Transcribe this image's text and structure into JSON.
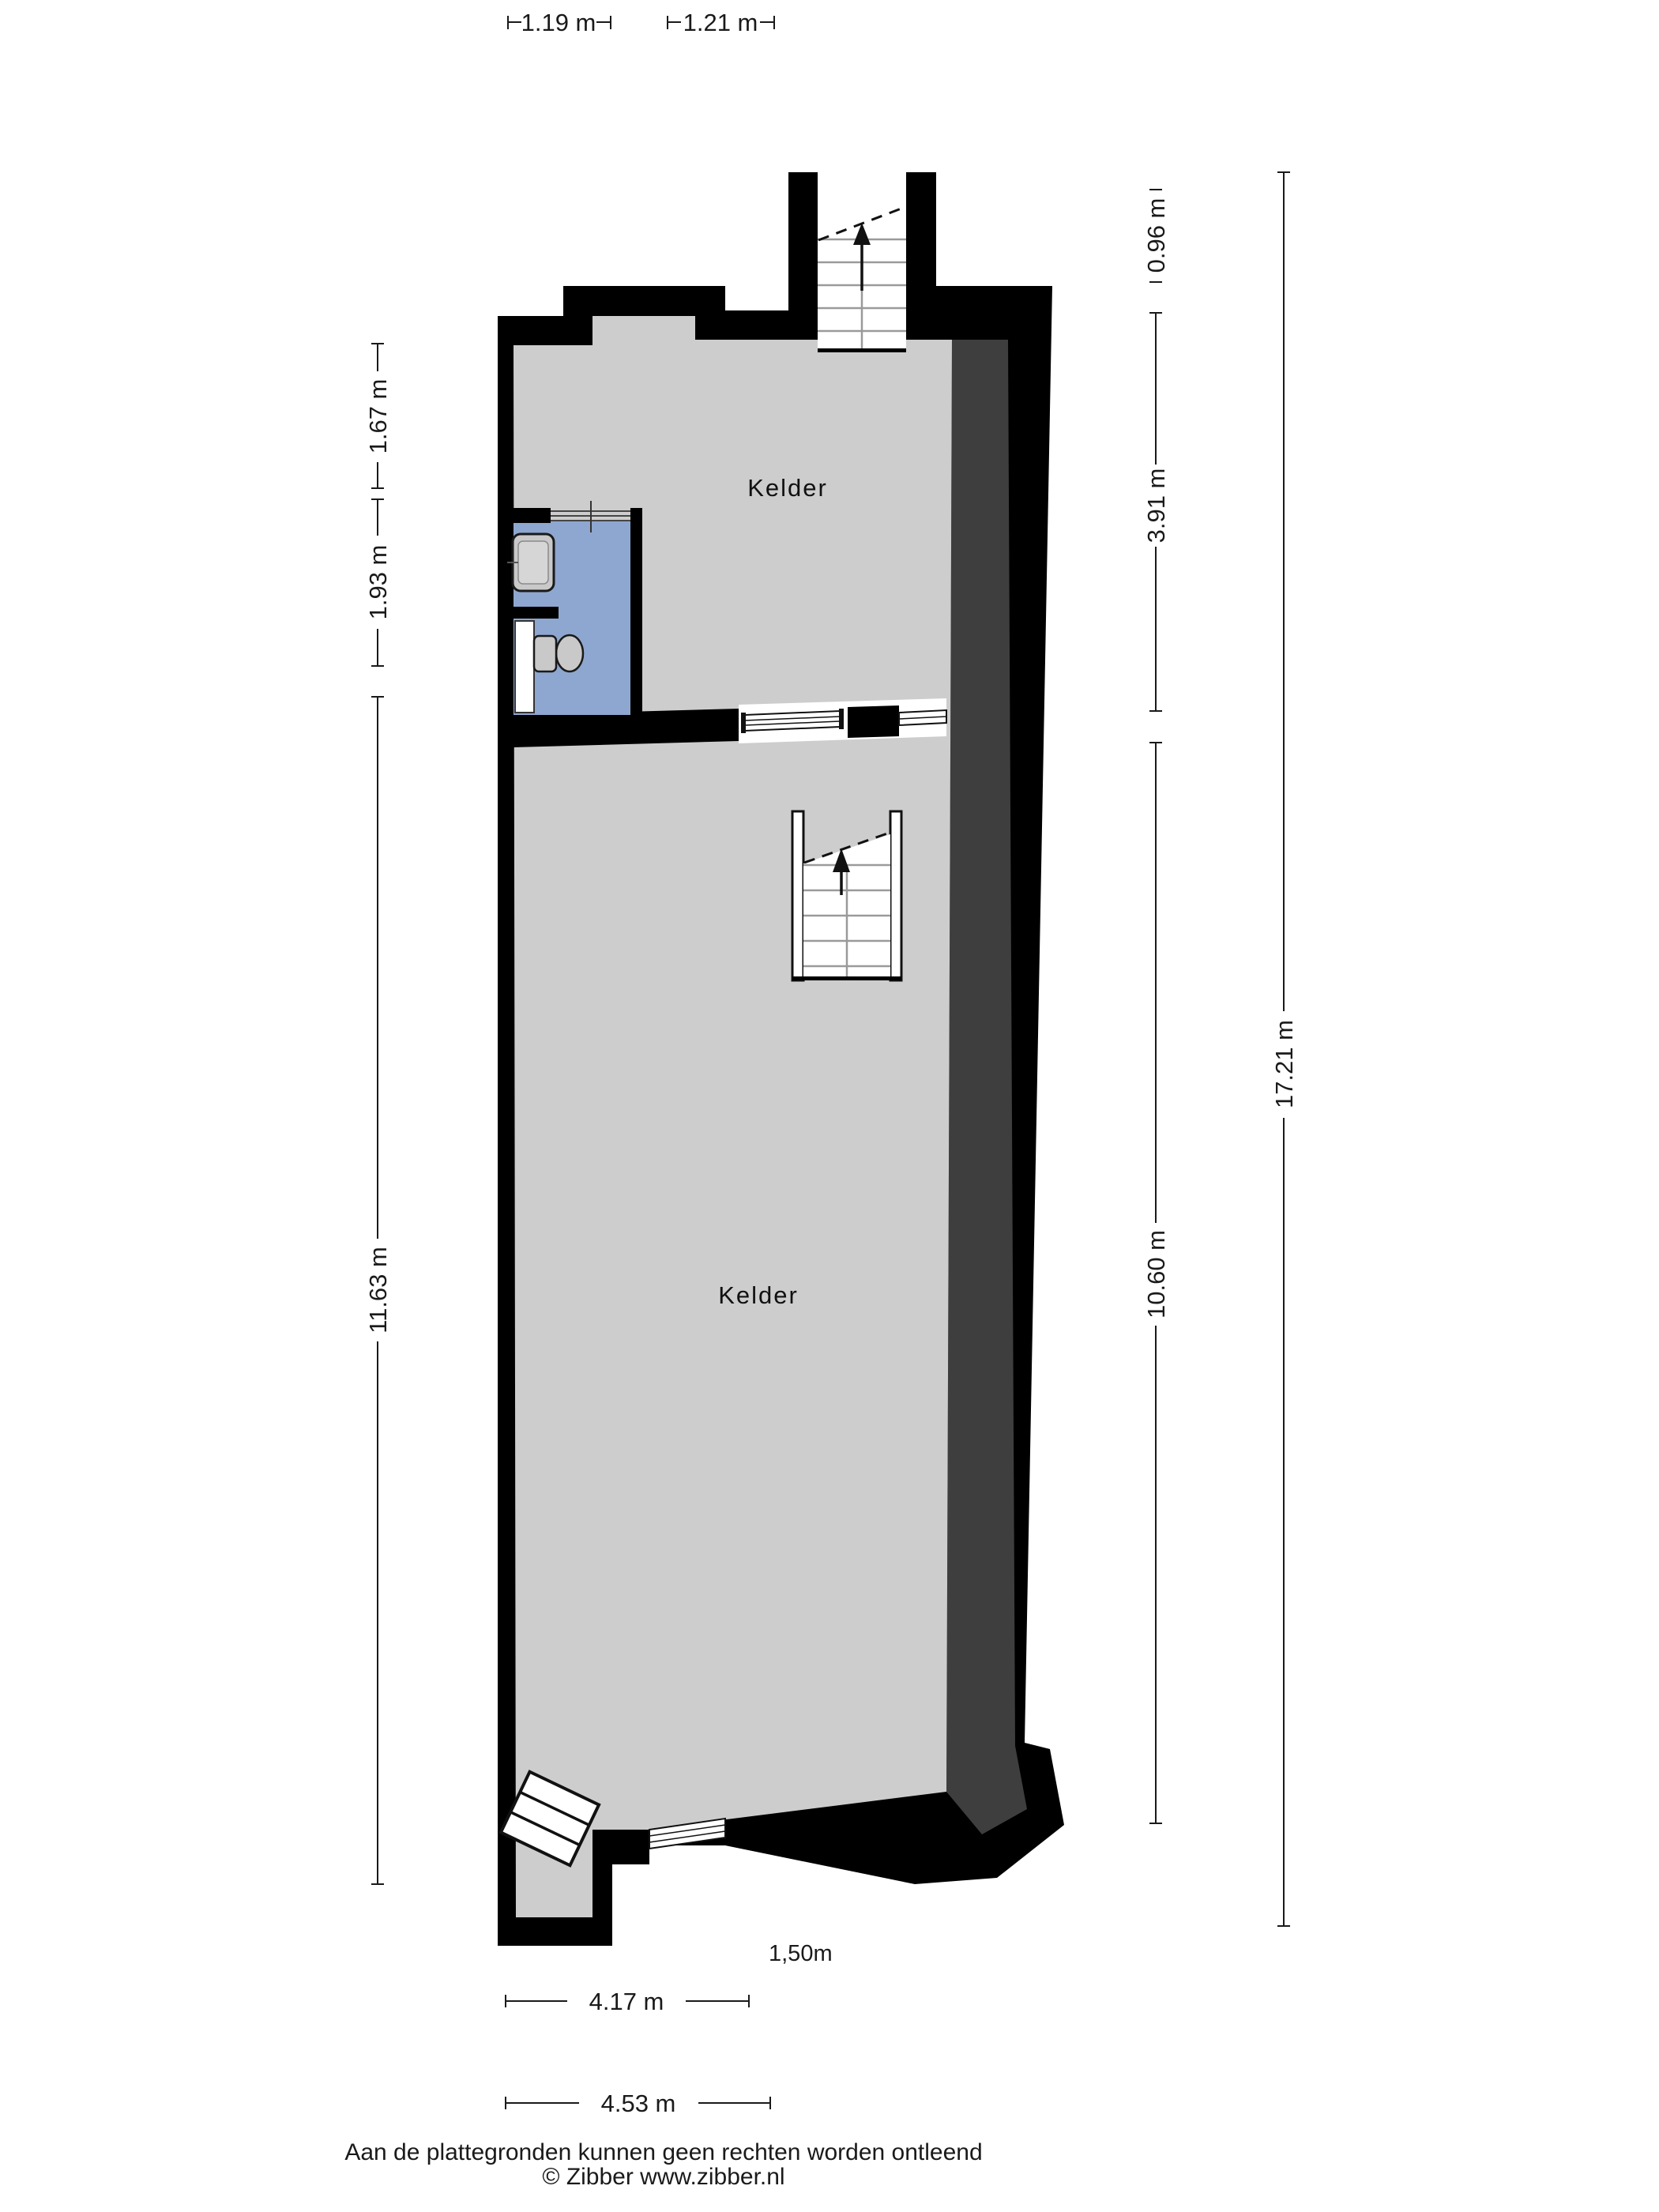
{
  "plan": {
    "rooms": [
      {
        "label": "Kelder"
      },
      {
        "label": "Kelder"
      }
    ],
    "height_marker": "1,50m"
  },
  "dimensions": {
    "top": [
      {
        "label": "1.19 m"
      },
      {
        "label": "1.21 m"
      }
    ],
    "left": [
      {
        "label": "1.67 m"
      },
      {
        "label": "1.93 m"
      },
      {
        "label": "11.63 m"
      }
    ],
    "right": [
      {
        "label": "0.96 m"
      },
      {
        "label": "3.91 m"
      },
      {
        "label": "10.60 m"
      },
      {
        "label": "17.21 m"
      }
    ],
    "bottom": [
      {
        "label": "4.17 m"
      },
      {
        "label": "4.53 m"
      }
    ]
  },
  "footer": {
    "disclaimer": "Aan de plattegronden kunnen geen rechten worden ontleend",
    "copyright": "© Zibber www.zibber.nl"
  },
  "colors": {
    "wall": "#000000",
    "wall_accent": "#3e3e3e",
    "floor": "#cdcdcd",
    "bathroom_floor": "#8ea7d0",
    "fixture": "#c9c9c9"
  }
}
